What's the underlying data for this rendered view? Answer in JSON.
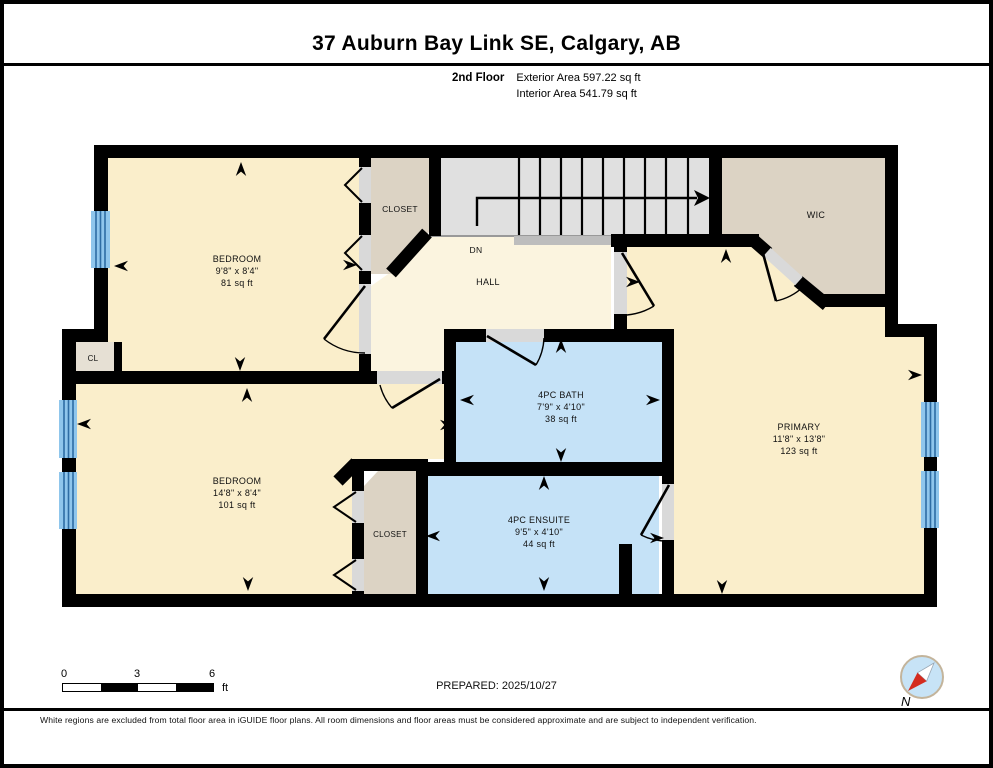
{
  "header": {
    "title": "37 Auburn Bay Link SE, Calgary, AB",
    "floor_label": "2nd Floor",
    "exterior_area": "Exterior Area 597.22 sq ft",
    "interior_area": "Interior Area 541.79 sq ft"
  },
  "rooms": {
    "bedroom1": {
      "name": "BEDROOM",
      "dims": "9'8\" x 8'4\"",
      "area": "81 sq ft"
    },
    "closet1": {
      "name": "CLOSET"
    },
    "stairs": {
      "direction": "DN"
    },
    "hall": {
      "name": "HALL"
    },
    "wic": {
      "name": "WIC"
    },
    "primary": {
      "name": "PRIMARY",
      "dims": "11'8\" x 13'8\"",
      "area": "123 sq ft"
    },
    "bath": {
      "name": "4PC BATH",
      "dims": "7'9\" x 4'10\"",
      "area": "38 sq ft"
    },
    "ensuite": {
      "name": "4PC ENSUITE",
      "dims": "9'5\" x 4'10\"",
      "area": "44 sq ft"
    },
    "bedroom2": {
      "name": "BEDROOM",
      "dims": "14'8\" x 8'4\"",
      "area": "101 sq ft"
    },
    "closet2": {
      "name": "CLOSET"
    },
    "cl": {
      "name": "CL"
    }
  },
  "scale_bar": {
    "tick0": "0",
    "tick1": "3",
    "tick2": "6",
    "unit": "ft"
  },
  "compass": {
    "north_label": "N"
  },
  "footer": {
    "prepared": "PREPARED: 2025/10/27",
    "disclaimer": "White regions are excluded from total floor area in iGUIDE floor plans. All room dimensions and floor areas must be considered approximate and are subject to independent verification."
  },
  "colors": {
    "room": "#FAEECB",
    "hall": "#FBF4DF",
    "bath": "#C5E2F7",
    "closet": "#DCD3C4",
    "closet_light": "#E6E0D4",
    "stairs": "#E0E0E0",
    "landing": "#BDBDBD",
    "opening": "#D9D9D9",
    "window": "#8FC6EC",
    "window_line": "#2E6DA4",
    "wall": "#000000",
    "compass_fill": "#C7E3F6",
    "compass_ring": "#C3B49B",
    "compass_red": "#D42B1E"
  }
}
